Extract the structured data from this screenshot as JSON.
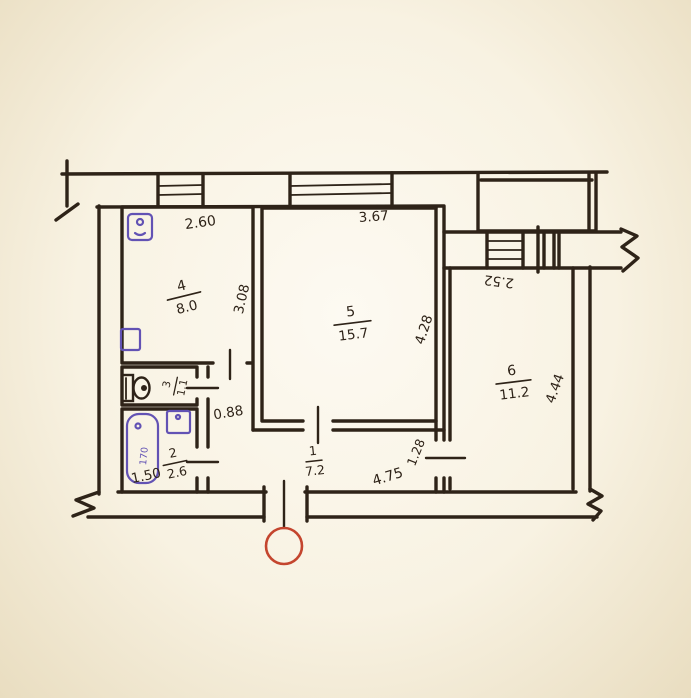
{
  "colors": {
    "ink": "#2e2318",
    "fixture": "#6252b4",
    "entry": "#c4452e",
    "paper": "#f8f2e2"
  },
  "rooms": {
    "hall": {
      "number": "1",
      "area": "7.2"
    },
    "bathroom": {
      "number": "2",
      "area": "2.6"
    },
    "wc": {
      "number": "3",
      "area": "1.1"
    },
    "kitchen": {
      "number": "4",
      "area": "8.0"
    },
    "living": {
      "number": "5",
      "area": "15.7"
    },
    "bedroom": {
      "number": "6",
      "area": "11.2"
    }
  },
  "dimensions": {
    "kitchen_width": "2.60",
    "kitchen_depth": "3.08",
    "living_width": "3.67",
    "living_depth": "4.28",
    "bedroom_width": "2.52",
    "bedroom_depth": "4.44",
    "hall_width": "0.88",
    "hall_length": "4.75",
    "bathroom_width": "1.50",
    "bedroom_entry": "1.28",
    "bathtub_length": "170"
  }
}
